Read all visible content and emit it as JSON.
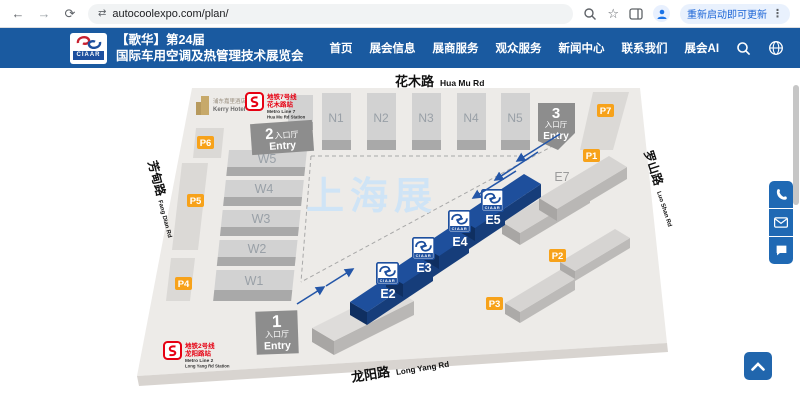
{
  "browser": {
    "url": "autocoolexpo.com/plan/",
    "update_button": "重新启动即可更新"
  },
  "icons": {
    "back": "←",
    "forward": "→",
    "reload": "⟳",
    "site": "⇄",
    "star": "☆",
    "menu_dots": "⋮"
  },
  "header": {
    "logo_text": "CIAAR",
    "title_line1": "【歌华】第24届",
    "title_line2": "国际车用空调及热管理技术展览会",
    "nav": [
      "首页",
      "展会信息",
      "展商服务",
      "观众服务",
      "新闻中心",
      "联系我们",
      "展会AI"
    ]
  },
  "map": {
    "watermark": "上海展",
    "badge_logo": "CIAAR",
    "roads": {
      "huamu_cn": "花木路",
      "huamu_en": "Hua Mu Rd",
      "fangdian_cn": "芳甸路",
      "fangdian_en": "Fang Dian Rd",
      "luoshan_cn": "罗山路",
      "luoshan_en": "Luo Shan Rd",
      "longyang_cn": "龙阳路",
      "longyang_en": "Long Yang Rd"
    },
    "halls_n": [
      "N1",
      "N2",
      "N3",
      "N4",
      "N5"
    ],
    "halls_w": [
      "W5",
      "W4",
      "W3",
      "W2",
      "W1"
    ],
    "halls_e": {
      "e1": "E1",
      "e2": "E2",
      "e3": "E3",
      "e4": "E4",
      "e5": "E5",
      "e6": "E6",
      "e7": "E7"
    },
    "parking": {
      "p1": "P1",
      "p2": "P2",
      "p3": "P3",
      "p4": "P4",
      "p5": "P5",
      "p6": "P6",
      "p7": "P7"
    },
    "entries": {
      "one": {
        "num": "1",
        "hall": "入口厅",
        "entry": "Entry"
      },
      "two": {
        "num": "2",
        "hall": "入口厅",
        "entry": "Entry"
      },
      "three": {
        "num": "3",
        "hall": "入口厅",
        "entry": "Entry"
      }
    },
    "hotel": {
      "cn": "浦东嘉里酒店",
      "en": "Kerry Hotel"
    },
    "metro7": {
      "line_cn": "地铁7号线",
      "station_cn": "花木路站",
      "line_en": "Metro Line 7",
      "station_en": "Hua Mu Rd Station"
    },
    "metro2": {
      "line_cn": "地铁2号线",
      "station_cn": "龙阳路站",
      "line_en": "Metro Line 2",
      "station_en": "Long Yang Rd Station"
    }
  },
  "colors": {
    "header_blue": "#1a5aa0",
    "hall_blue": "#1e4f9c",
    "parking_orange": "#f7a21a"
  }
}
